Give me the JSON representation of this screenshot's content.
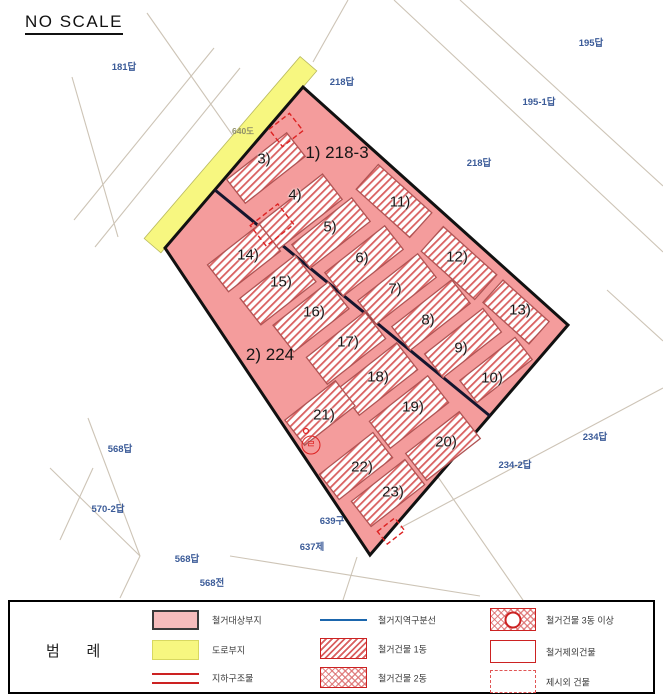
{
  "title": "NO SCALE",
  "map": {
    "outline_points": "303,87 568,325 370,555 165,248",
    "road_quad_points": "316.8,70.9 160.9,252.8 144.2,238.5 300.1,56.6",
    "division_line": {
      "x1": 215,
      "y1": 190,
      "x2": 490,
      "y2": 416
    },
    "area_labels": [
      {
        "text": "1) 218-3",
        "x": 337,
        "y": 153
      },
      {
        "text": "2) 224",
        "x": 270,
        "y": 355
      }
    ],
    "parcel_labels": [
      {
        "text": "181답",
        "x": 124,
        "y": 66,
        "muted": false
      },
      {
        "text": "218답",
        "x": 342,
        "y": 81,
        "muted": false
      },
      {
        "text": "195답",
        "x": 591,
        "y": 42,
        "muted": false
      },
      {
        "text": "195-1답",
        "x": 539,
        "y": 101,
        "muted": false
      },
      {
        "text": "218답",
        "x": 479,
        "y": 162,
        "muted": false
      },
      {
        "text": "640도",
        "x": 243,
        "y": 131,
        "muted": true
      },
      {
        "text": "234답",
        "x": 595,
        "y": 436,
        "muted": false
      },
      {
        "text": "234-2답",
        "x": 515,
        "y": 464,
        "muted": false
      },
      {
        "text": "568답",
        "x": 120,
        "y": 448,
        "muted": false
      },
      {
        "text": "570-2답",
        "x": 108,
        "y": 508,
        "muted": false
      },
      {
        "text": "568답",
        "x": 187,
        "y": 558,
        "muted": false
      },
      {
        "text": "568전",
        "x": 212,
        "y": 582,
        "muted": false
      },
      {
        "text": "639구",
        "x": 332,
        "y": 520,
        "muted": false
      },
      {
        "text": "637제",
        "x": 312,
        "y": 546,
        "muted": false
      }
    ],
    "buildings": [
      {
        "label": "3)",
        "cx": 266,
        "cy": 168,
        "l": 76,
        "w": 30,
        "a": -38,
        "lx": 264,
        "ly": 159
      },
      {
        "label": "4)",
        "cx": 300,
        "cy": 212,
        "l": 82,
        "w": 32,
        "a": -38,
        "lx": 295,
        "ly": 195
      },
      {
        "label": "5)",
        "cx": 331,
        "cy": 233,
        "l": 76,
        "w": 30,
        "a": -38,
        "lx": 330,
        "ly": 227
      },
      {
        "label": "6)",
        "cx": 364,
        "cy": 261,
        "l": 76,
        "w": 30,
        "a": -38,
        "lx": 362,
        "ly": 258
      },
      {
        "label": "7)",
        "cx": 397,
        "cy": 289,
        "l": 76,
        "w": 30,
        "a": -38,
        "lx": 395,
        "ly": 289
      },
      {
        "label": "8)",
        "cx": 431,
        "cy": 315,
        "l": 76,
        "w": 30,
        "a": -38,
        "lx": 428,
        "ly": 320
      },
      {
        "label": "9)",
        "cx": 463,
        "cy": 343,
        "l": 74,
        "w": 30,
        "a": -38,
        "lx": 461,
        "ly": 348
      },
      {
        "label": "10)",
        "cx": 496,
        "cy": 370,
        "l": 70,
        "w": 28,
        "a": -38,
        "lx": 492,
        "ly": 378
      },
      {
        "label": "11)",
        "cx": 394,
        "cy": 201,
        "l": 72,
        "w": 33,
        "a": 42,
        "lx": 400,
        "ly": 202
      },
      {
        "label": "12)",
        "cx": 459,
        "cy": 263,
        "l": 72,
        "w": 33,
        "a": 42,
        "lx": 457,
        "ly": 257
      },
      {
        "label": "13)",
        "cx": 516,
        "cy": 312,
        "l": 62,
        "w": 30,
        "a": 42,
        "lx": 520,
        "ly": 310
      },
      {
        "label": "14)",
        "cx": 244,
        "cy": 258,
        "l": 66,
        "w": 34,
        "a": -38,
        "lx": 248,
        "ly": 255
      },
      {
        "label": "15)",
        "cx": 278,
        "cy": 290,
        "l": 70,
        "w": 34,
        "a": -38,
        "lx": 281,
        "ly": 282
      },
      {
        "label": "16)",
        "cx": 311,
        "cy": 317,
        "l": 70,
        "w": 34,
        "a": -38,
        "lx": 314,
        "ly": 312
      },
      {
        "label": "17)",
        "cx": 346,
        "cy": 348,
        "l": 74,
        "w": 34,
        "a": -38,
        "lx": 348,
        "ly": 342
      },
      {
        "label": "18)",
        "cx": 378,
        "cy": 379,
        "l": 74,
        "w": 34,
        "a": -38,
        "lx": 378,
        "ly": 377
      },
      {
        "label": "19)",
        "cx": 409,
        "cy": 412,
        "l": 74,
        "w": 34,
        "a": -38,
        "lx": 413,
        "ly": 407
      },
      {
        "label": "20)",
        "cx": 443,
        "cy": 446,
        "l": 68,
        "w": 34,
        "a": -38,
        "lx": 446,
        "ly": 442
      },
      {
        "label": "21)",
        "cx": 320,
        "cy": 413,
        "l": 64,
        "w": 32,
        "a": -38,
        "lx": 324,
        "ly": 415
      },
      {
        "label": "22)",
        "cx": 356,
        "cy": 466,
        "l": 68,
        "w": 32,
        "a": -38,
        "lx": 362,
        "ly": 467
      },
      {
        "label": "23)",
        "cx": 388,
        "cy": 493,
        "l": 68,
        "w": 32,
        "a": -38,
        "lx": 393,
        "ly": 492
      }
    ],
    "dashed_symbols": [
      {
        "x": 286,
        "y": 130,
        "w": 26,
        "h": 22,
        "a": -38
      },
      {
        "x": 272,
        "y": 225,
        "w": 35,
        "h": 26,
        "a": -38
      },
      {
        "x": 391,
        "y": 531,
        "w": 22,
        "h": 16,
        "a": -38
      }
    ],
    "circle_mark": {
      "text": "ㄹ",
      "x": 311,
      "y": 445
    },
    "small_circle": {
      "x": 306,
      "y": 431
    },
    "background_lines": [
      [
        147,
        13,
        250,
        160
      ],
      [
        72,
        77,
        118,
        237
      ],
      [
        240,
        68,
        95,
        247
      ],
      [
        214,
        48,
        74,
        220
      ],
      [
        460,
        0,
        663,
        186
      ],
      [
        394,
        0,
        663,
        252
      ],
      [
        348,
        0,
        313,
        62
      ],
      [
        607,
        290,
        663,
        341
      ],
      [
        663,
        388,
        400,
        528
      ],
      [
        436,
        474,
        523,
        600
      ],
      [
        230,
        556,
        480,
        596
      ],
      [
        88,
        418,
        140,
        556
      ],
      [
        50,
        468,
        140,
        556
      ],
      [
        140,
        556,
        120,
        598
      ],
      [
        357,
        557,
        343,
        600
      ],
      [
        60,
        540,
        93,
        468
      ]
    ]
  },
  "legend": {
    "title": "범    례",
    "items": [
      {
        "swatch": "pink-fill",
        "label": "철거대상부지"
      },
      {
        "swatch": "yellow-fill",
        "label": "도로부지"
      },
      {
        "swatch": "double-red-line",
        "label": "지하구조물"
      },
      {
        "swatch": "blue-line",
        "label": "철거지역구분선"
      },
      {
        "swatch": "diagonal-hatch",
        "label": "철거건물 1동"
      },
      {
        "swatch": "cross-hatch",
        "label": "철거건물 2동"
      },
      {
        "swatch": "cross-hatch-circle",
        "label": "철거건물 3동 이상"
      },
      {
        "swatch": "red-outline",
        "label": "철거제외건물"
      },
      {
        "swatch": "red-dashed-outline",
        "label": "제시외 건물"
      }
    ]
  },
  "colors": {
    "site_fill": "#f49c9c",
    "site_border": "#111111",
    "road_fill": "#f7f780",
    "hatch_stripe": "#d96060",
    "building_border": "#b05454",
    "background_line": "#cdc4b6",
    "parcel_text": "#3b5b98",
    "symbol_red": "#dd2222",
    "legend_blue": "#1b66ad"
  }
}
